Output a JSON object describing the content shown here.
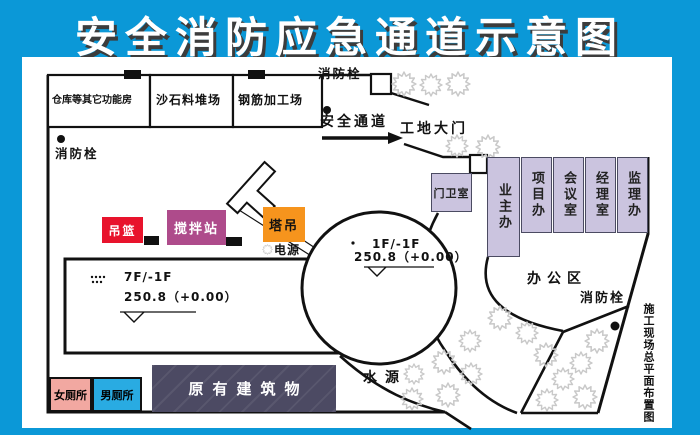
{
  "title": "安全消防应急通道示意图",
  "side_caption": "施工现场总平面布置图",
  "colors": {
    "frame_blue": "#0b98d7",
    "room_lavender": "#cbc4df",
    "basket_red": "#e8132c",
    "mixer_plum": "#ae4b8b",
    "crane_orange": "#f6941d",
    "existing_dark": "#4c4a63",
    "toilet_pink": "#f2a8a1",
    "toilet_blue": "#29abe2"
  },
  "top_buildings": [
    {
      "label": "仓库等其它功能房"
    },
    {
      "label": "沙石料堆场"
    },
    {
      "label": "钢筋加工场"
    }
  ],
  "hydrants": {
    "top": "消防栓",
    "left": "消防栓",
    "right": "消防栓"
  },
  "gate": {
    "passage": "安全通道",
    "gate_label": "工地大门",
    "guard_room": "门卫室"
  },
  "offices": {
    "area_label": "办公区",
    "rooms": [
      {
        "label": "业主办"
      },
      {
        "label": "项目办"
      },
      {
        "label": "会议室"
      },
      {
        "label": "经理室"
      },
      {
        "label": "监理办"
      }
    ]
  },
  "equipment": {
    "basket": "吊篮",
    "mixer": "搅拌站",
    "crane": "塔吊",
    "power": "电源"
  },
  "main_building": {
    "floors": "7F/-1F",
    "elevation": "250.8（+0.00）"
  },
  "round_building": {
    "floors": "1F/-1F",
    "elevation": "250.8（+0.00）"
  },
  "water_source": "水源",
  "bottom_buildings": {
    "womens_toilet": "女厕所",
    "mens_toilet": "男厕所",
    "existing": "原有建筑物"
  }
}
